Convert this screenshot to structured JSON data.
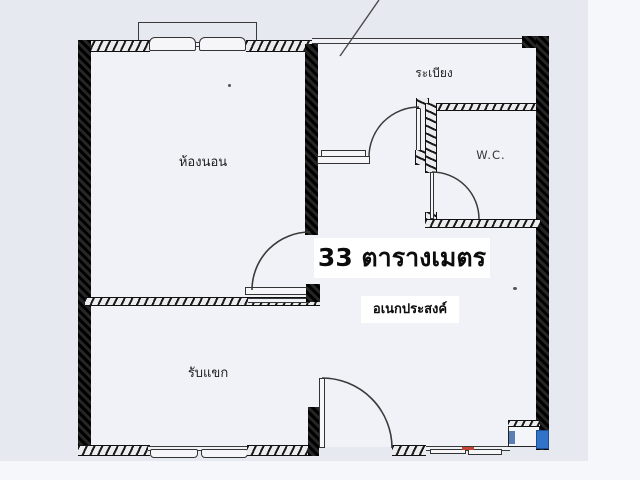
{
  "floorplan": {
    "total_area_label": "33 ตารางเมตร",
    "labels": {
      "bedroom": "ห้องนอน",
      "balcony": "ระเบียง",
      "wc": "W.C.",
      "living_room": "รับแขก",
      "multipurpose": "อเนกประสงค์"
    },
    "colors": {
      "background": "#e7e9f1",
      "paper": "#f1f2f7",
      "wall": "#141414",
      "line": "#3a3a3a",
      "accent_blue": "#3272c8",
      "accent_red": "#c44433"
    }
  }
}
